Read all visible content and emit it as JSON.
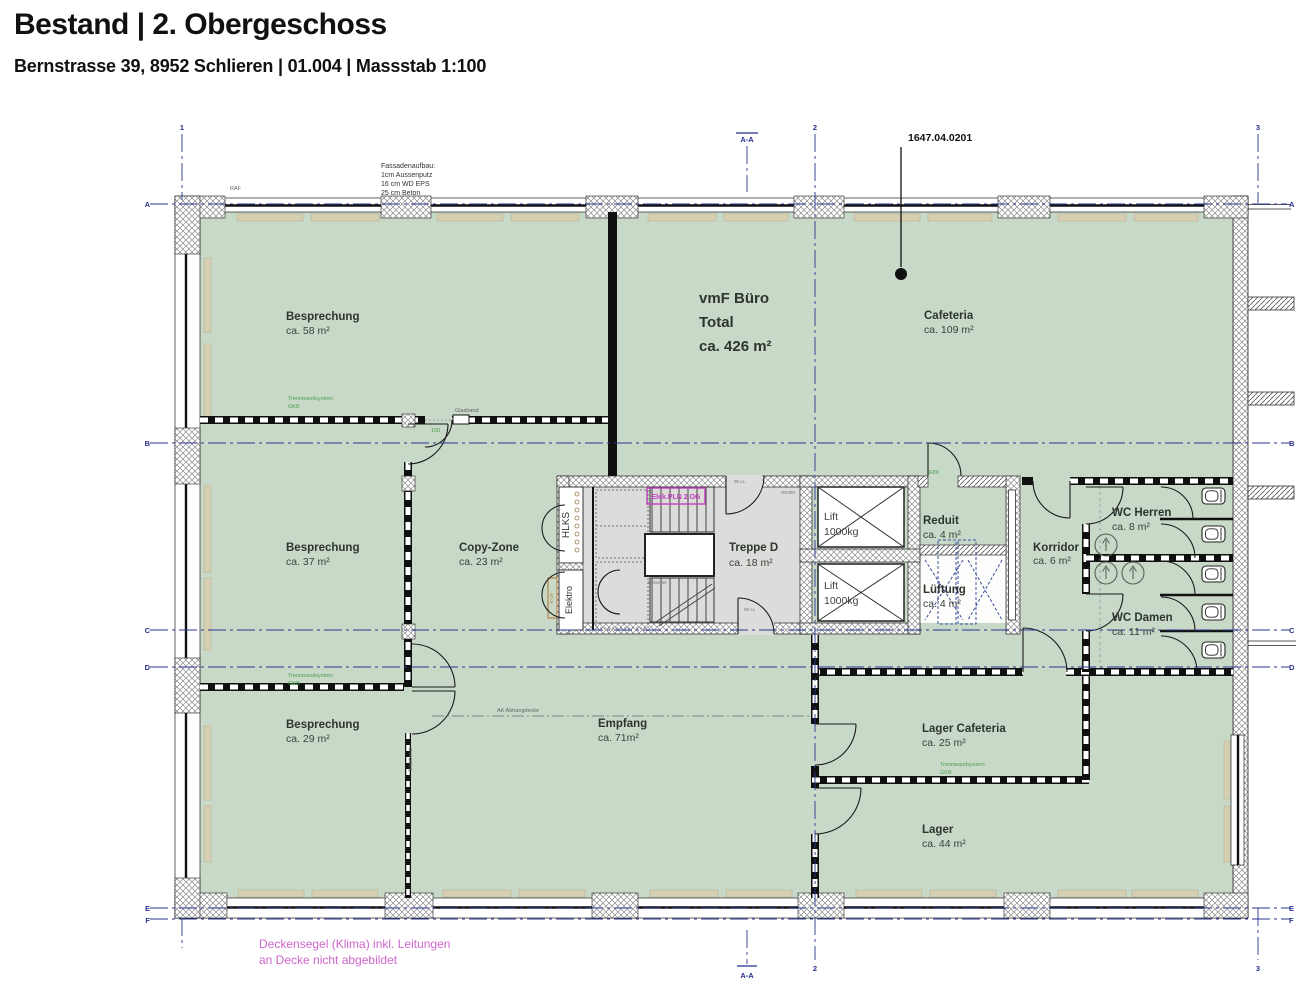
{
  "header": {
    "title": "Bestand | 2. Obergeschoss",
    "subtitle": "Bernstrasse 39, 8952 Schlieren | 01.004 | Massstab 1:100"
  },
  "plan": {
    "drawing_number": "1647.04.0201",
    "grid": {
      "rows": [
        "A",
        "B",
        "C",
        "D",
        "E",
        "F"
      ],
      "cols": [
        "1",
        "2",
        "3"
      ],
      "section": "A-A"
    },
    "vmf": {
      "line1": "vmF Büro",
      "line2": "Total",
      "line3": "ca. 426 m²"
    },
    "rooms": [
      {
        "name": "Besprechung",
        "area": "ca. 58 m²"
      },
      {
        "name": "Cafeteria",
        "area": "ca. 109 m²"
      },
      {
        "name": "Besprechung",
        "area": "ca. 37 m²"
      },
      {
        "name": "Copy-Zone",
        "area": "ca. 23 m²"
      },
      {
        "name": "Treppe D",
        "area": "ca. 18 m²"
      },
      {
        "name": "Reduit",
        "area": "ca. 4 m²"
      },
      {
        "name": "Lüftung",
        "area": "ca. 4 m²"
      },
      {
        "name": "Korridor",
        "area": "ca. 6 m²"
      },
      {
        "name": "WC Herren",
        "area": "ca. 8 m²"
      },
      {
        "name": "WC Damen",
        "area": "ca. 11 m²"
      },
      {
        "name": "Besprechung",
        "area": "ca. 29 m²"
      },
      {
        "name": "Empfang",
        "area": "ca. 71m²"
      },
      {
        "name": "Lager Cafeteria",
        "area": "ca. 25 m²"
      },
      {
        "name": "Lager",
        "area": "ca. 44 m²"
      }
    ],
    "lift": {
      "name": "Lift",
      "capacity": "1000kg"
    },
    "shafts": {
      "hlks": "HLKS",
      "elektro": "Elektro",
      "euv": "E-UV"
    },
    "notes": {
      "facade": [
        "Fassadenaufbau:",
        "1cm Aussenputz",
        "16 cm WD EPS",
        "25 cm Beton"
      ],
      "raf": "RAF",
      "ceiling": [
        "Deckensegel (Klima) inkl. Leitungen",
        "an Decke nicht abgebildet"
      ],
      "elek_box": "Elek.PLN 2.OG",
      "gelaender": "Geländer",
      "re360": "RE360",
      "door_size": "90 LL",
      "trennwand": [
        "Trennwandsystem",
        "GKB"
      ],
      "glasband": "Glasband",
      "abhangdecke": "AK Abhangdecke",
      "dim100": "100",
      "e80": "E80"
    },
    "colors": {
      "room_fill": "#c8d9c8",
      "core_fill": "#dcdcda",
      "sill": "#d6cfb2",
      "grid_blue": "#2a3590",
      "annotation_green": "#4aa04f",
      "note_magenta": "#cf66cc"
    }
  }
}
